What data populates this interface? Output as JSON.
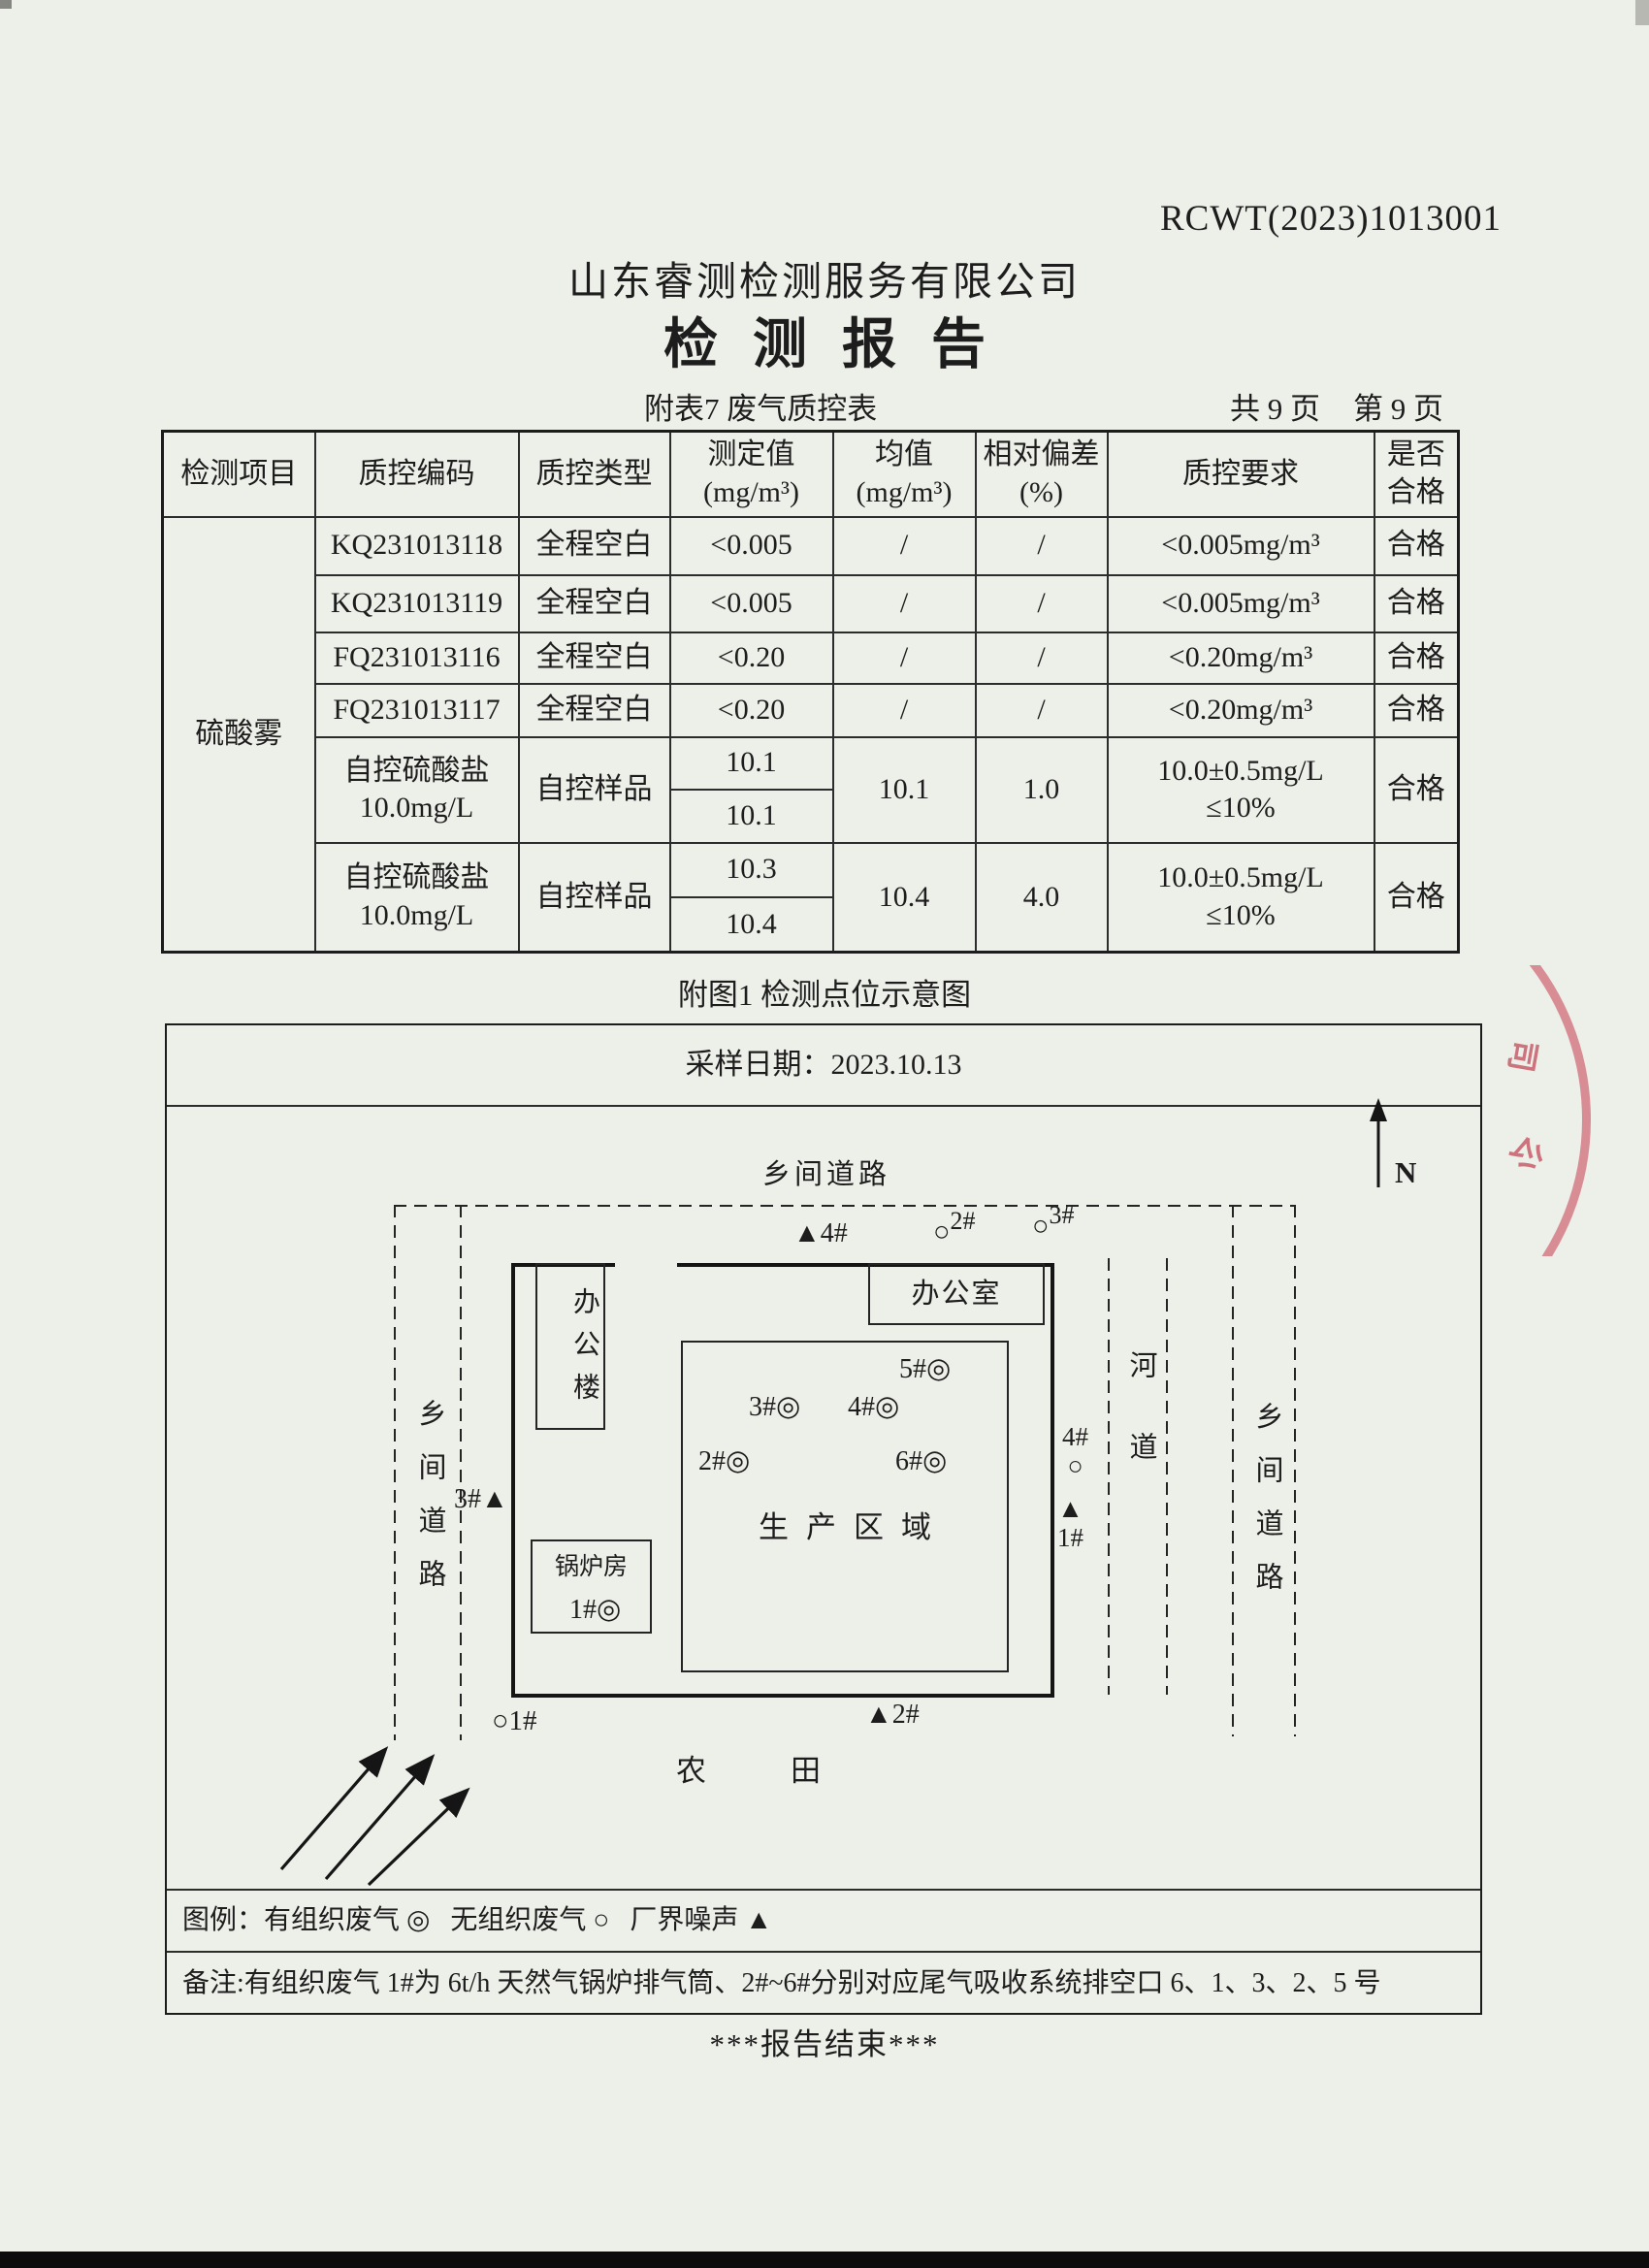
{
  "page": {
    "doc_code": "RCWT(2023)1013001",
    "company": "山东睿测检测服务有限公司",
    "title": "检测报告",
    "table_caption": "附表7 废气质控表",
    "page_count": "共 9 页",
    "page_number": "第 9 页",
    "figure_caption": "附图1 检测点位示意图",
    "end_note": "***报告结束***"
  },
  "qc_table": {
    "headers": {
      "item": "检测项目",
      "code": "质控编码",
      "type": "质控类型",
      "measured_l1": "测定值",
      "measured_l2": "(mg/m³)",
      "mean_l1": "均值",
      "mean_l2": "(mg/m³)",
      "rsd_l1": "相对偏差",
      "rsd_l2": "(%)",
      "requirement": "质控要求",
      "pass_l1": "是否",
      "pass_l2": "合格"
    },
    "item_name": "硫酸雾",
    "blank_rows": [
      {
        "code": "KQ231013118",
        "type": "全程空白",
        "measured": "<0.005",
        "mean": "/",
        "rsd": "/",
        "requirement": "<0.005mg/m³",
        "pass": "合格"
      },
      {
        "code": "KQ231013119",
        "type": "全程空白",
        "measured": "<0.005",
        "mean": "/",
        "rsd": "/",
        "requirement": "<0.005mg/m³",
        "pass": "合格"
      },
      {
        "code": "FQ231013116",
        "type": "全程空白",
        "measured": "<0.20",
        "mean": "/",
        "rsd": "/",
        "requirement": "<0.20mg/m³",
        "pass": "合格"
      },
      {
        "code": "FQ231013117",
        "type": "全程空白",
        "measured": "<0.20",
        "mean": "/",
        "rsd": "/",
        "requirement": "<0.20mg/m³",
        "pass": "合格"
      }
    ],
    "control_rows": [
      {
        "name_l1": "自控硫酸盐",
        "name_l2": "10.0mg/L",
        "type": "自控样品",
        "measured_1": "10.1",
        "measured_2": "10.1",
        "mean": "10.1",
        "rsd": "1.0",
        "req_l1": "10.0±0.5mg/L",
        "req_l2": "≤10%",
        "pass": "合格"
      },
      {
        "name_l1": "自控硫酸盐",
        "name_l2": "10.0mg/L",
        "type": "自控样品",
        "measured_1": "10.3",
        "measured_2": "10.4",
        "mean": "10.4",
        "rsd": "4.0",
        "req_l1": "10.0±0.5mg/L",
        "req_l2": "≤10%",
        "pass": "合格"
      }
    ]
  },
  "diagram": {
    "sample_date": "采样日期：2023.10.13",
    "north": "N",
    "road_top": "乡间道路",
    "road_left": "乡间道路",
    "road_right": "乡间道路",
    "river": "河道",
    "farm_left": "农",
    "farm_right": "田",
    "office_building": "办公楼",
    "office": "办公室",
    "production_area": "生产区域",
    "boiler_room": "锅炉房",
    "stack_points": {
      "p1_label": "1#",
      "p1_symbol": "◎",
      "p2_label": "2#",
      "p2_symbol": "◎",
      "p3_label": "3#",
      "p3_symbol": "◎",
      "p4_label": "4#",
      "p4_symbol": "◎",
      "p5_label": "5#",
      "p5_symbol": "◎",
      "p6_label": "6#",
      "p6_symbol": "◎"
    },
    "fugitive_points": {
      "p1_symbol": "○",
      "p1_label": "1#",
      "p2_symbol": "○",
      "p2_label": "2#",
      "p3_symbol": "○",
      "p3_label": "3#",
      "p4_symbol": "○",
      "p4_label": "4#"
    },
    "noise_points": {
      "p1_symbol": "▲",
      "p1_label": "1#",
      "p2_symbol": "▲",
      "p2_label": "2#",
      "p3_symbol": "▲",
      "p3_label": "3#",
      "p4_symbol": "▲",
      "p4_label": "4#"
    },
    "legend": "图例：有组织废气 ◎   无组织废气 ○   厂界噪声 ▲",
    "note": "备注:有组织废气 1#为 6t/h 天然气锅炉排气筒、2#~6#分别对应尾气吸收系统排空口 6、1、3、2、5 号"
  },
  "stamp": {
    "char_top": "司",
    "char_bottom": "公"
  },
  "colors": {
    "paper": "#edefe9",
    "ink": "#1d1d1d",
    "stamp_red": "#c42c42"
  }
}
